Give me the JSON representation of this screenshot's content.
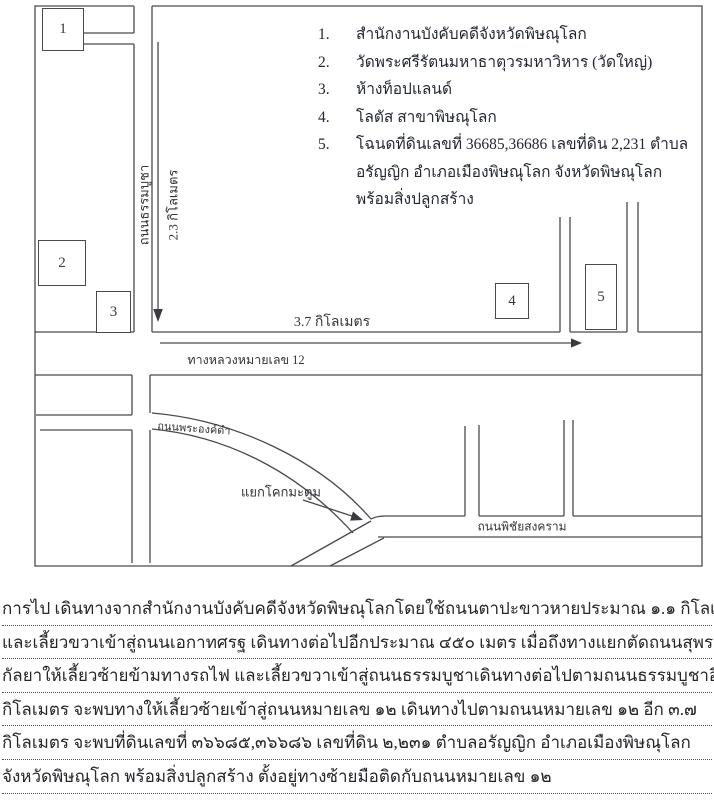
{
  "legend": {
    "items": [
      {
        "num": "1.",
        "text": "สำนักงานบังคับคดีจังหวัดพิษณุโลก"
      },
      {
        "num": "2.",
        "text": "วัดพระศรีรัตนมหาธาตุวรมหาวิหาร (วัดใหญ่)"
      },
      {
        "num": "3.",
        "text": "ห้างท็อปแลนด์"
      },
      {
        "num": "4.",
        "text": "โลตัส สาขาพิษณุโลก"
      },
      {
        "num": "5.",
        "text": "โฉนดที่ดินเลขที่ 36685,36686 เลขที่ดิน 2,231 ตำบลอรัญญิก อำเภอเมืองพิษณุโลก จังหวัดพิษณุโลก พร้อมสิ่งปลูกสร้าง"
      }
    ]
  },
  "map": {
    "markers": {
      "m1": "1",
      "m2": "2",
      "m3": "3",
      "m4": "4",
      "m5": "5"
    },
    "labels": {
      "thammabucha_road": "ถนนธรรมบูชา",
      "dist_2_3": "2.3 กิโลเมตร",
      "dist_3_7": "3.7 กิโลเมตร",
      "highway_12": "ทางหลวงหมายเลข 12",
      "phra_ong_dam_road": "ถนนพระองค์ดำ",
      "khok_matum_junction": "แยกโคกมะตูม",
      "phichai_songkhram_road": "ถนนพิชัยสงคราม"
    },
    "line_color": "#4a4a4a"
  },
  "directions": {
    "lines": [
      "การไป เดินทางจากสำนักงานบังคับคดีจังหวัดพิษณุโลกโดยใช้ถนนตาปะขาวหายประมาณ ๑.๑ กิโลเมตร",
      "และเลี้ยวขวาเข้าสู่ถนนเอกาทศรฐ เดินทางต่อไปอีกประมาณ ๔๕๐ เมตร เมื่อถึงทางแยกตัดถนนสุพรรณ",
      "กัลยาให้เลี้ยวซ้ายข้ามทางรถไฟ และเลี้ยวขวาเข้าสู่ถนนธรรมบูชาเดินทางต่อไปตามถนนธรรมบูชาอีก ๒.๓",
      "กิโลเมตร จะพบทางให้เลี้ยวซ้ายเข้าสู่ถนนหมายเลข ๑๒ เดินทางไปตามถนนหมายเลข ๑๒ อีก ๓.๗",
      "กิโลเมตร จะพบที่ดินเลขที่ ๓๖๖๘๕,๓๖๖๘๖ เลขที่ดิน ๒,๒๓๑ ตำบลอรัญญิก อำเภอเมืองพิษณุโลก",
      "จังหวัดพิษณุโลก พร้อมสิ่งปลูกสร้าง ตั้งอยู่ทางซ้ายมือติดกับถนนหมายเลข ๑๒"
    ]
  }
}
